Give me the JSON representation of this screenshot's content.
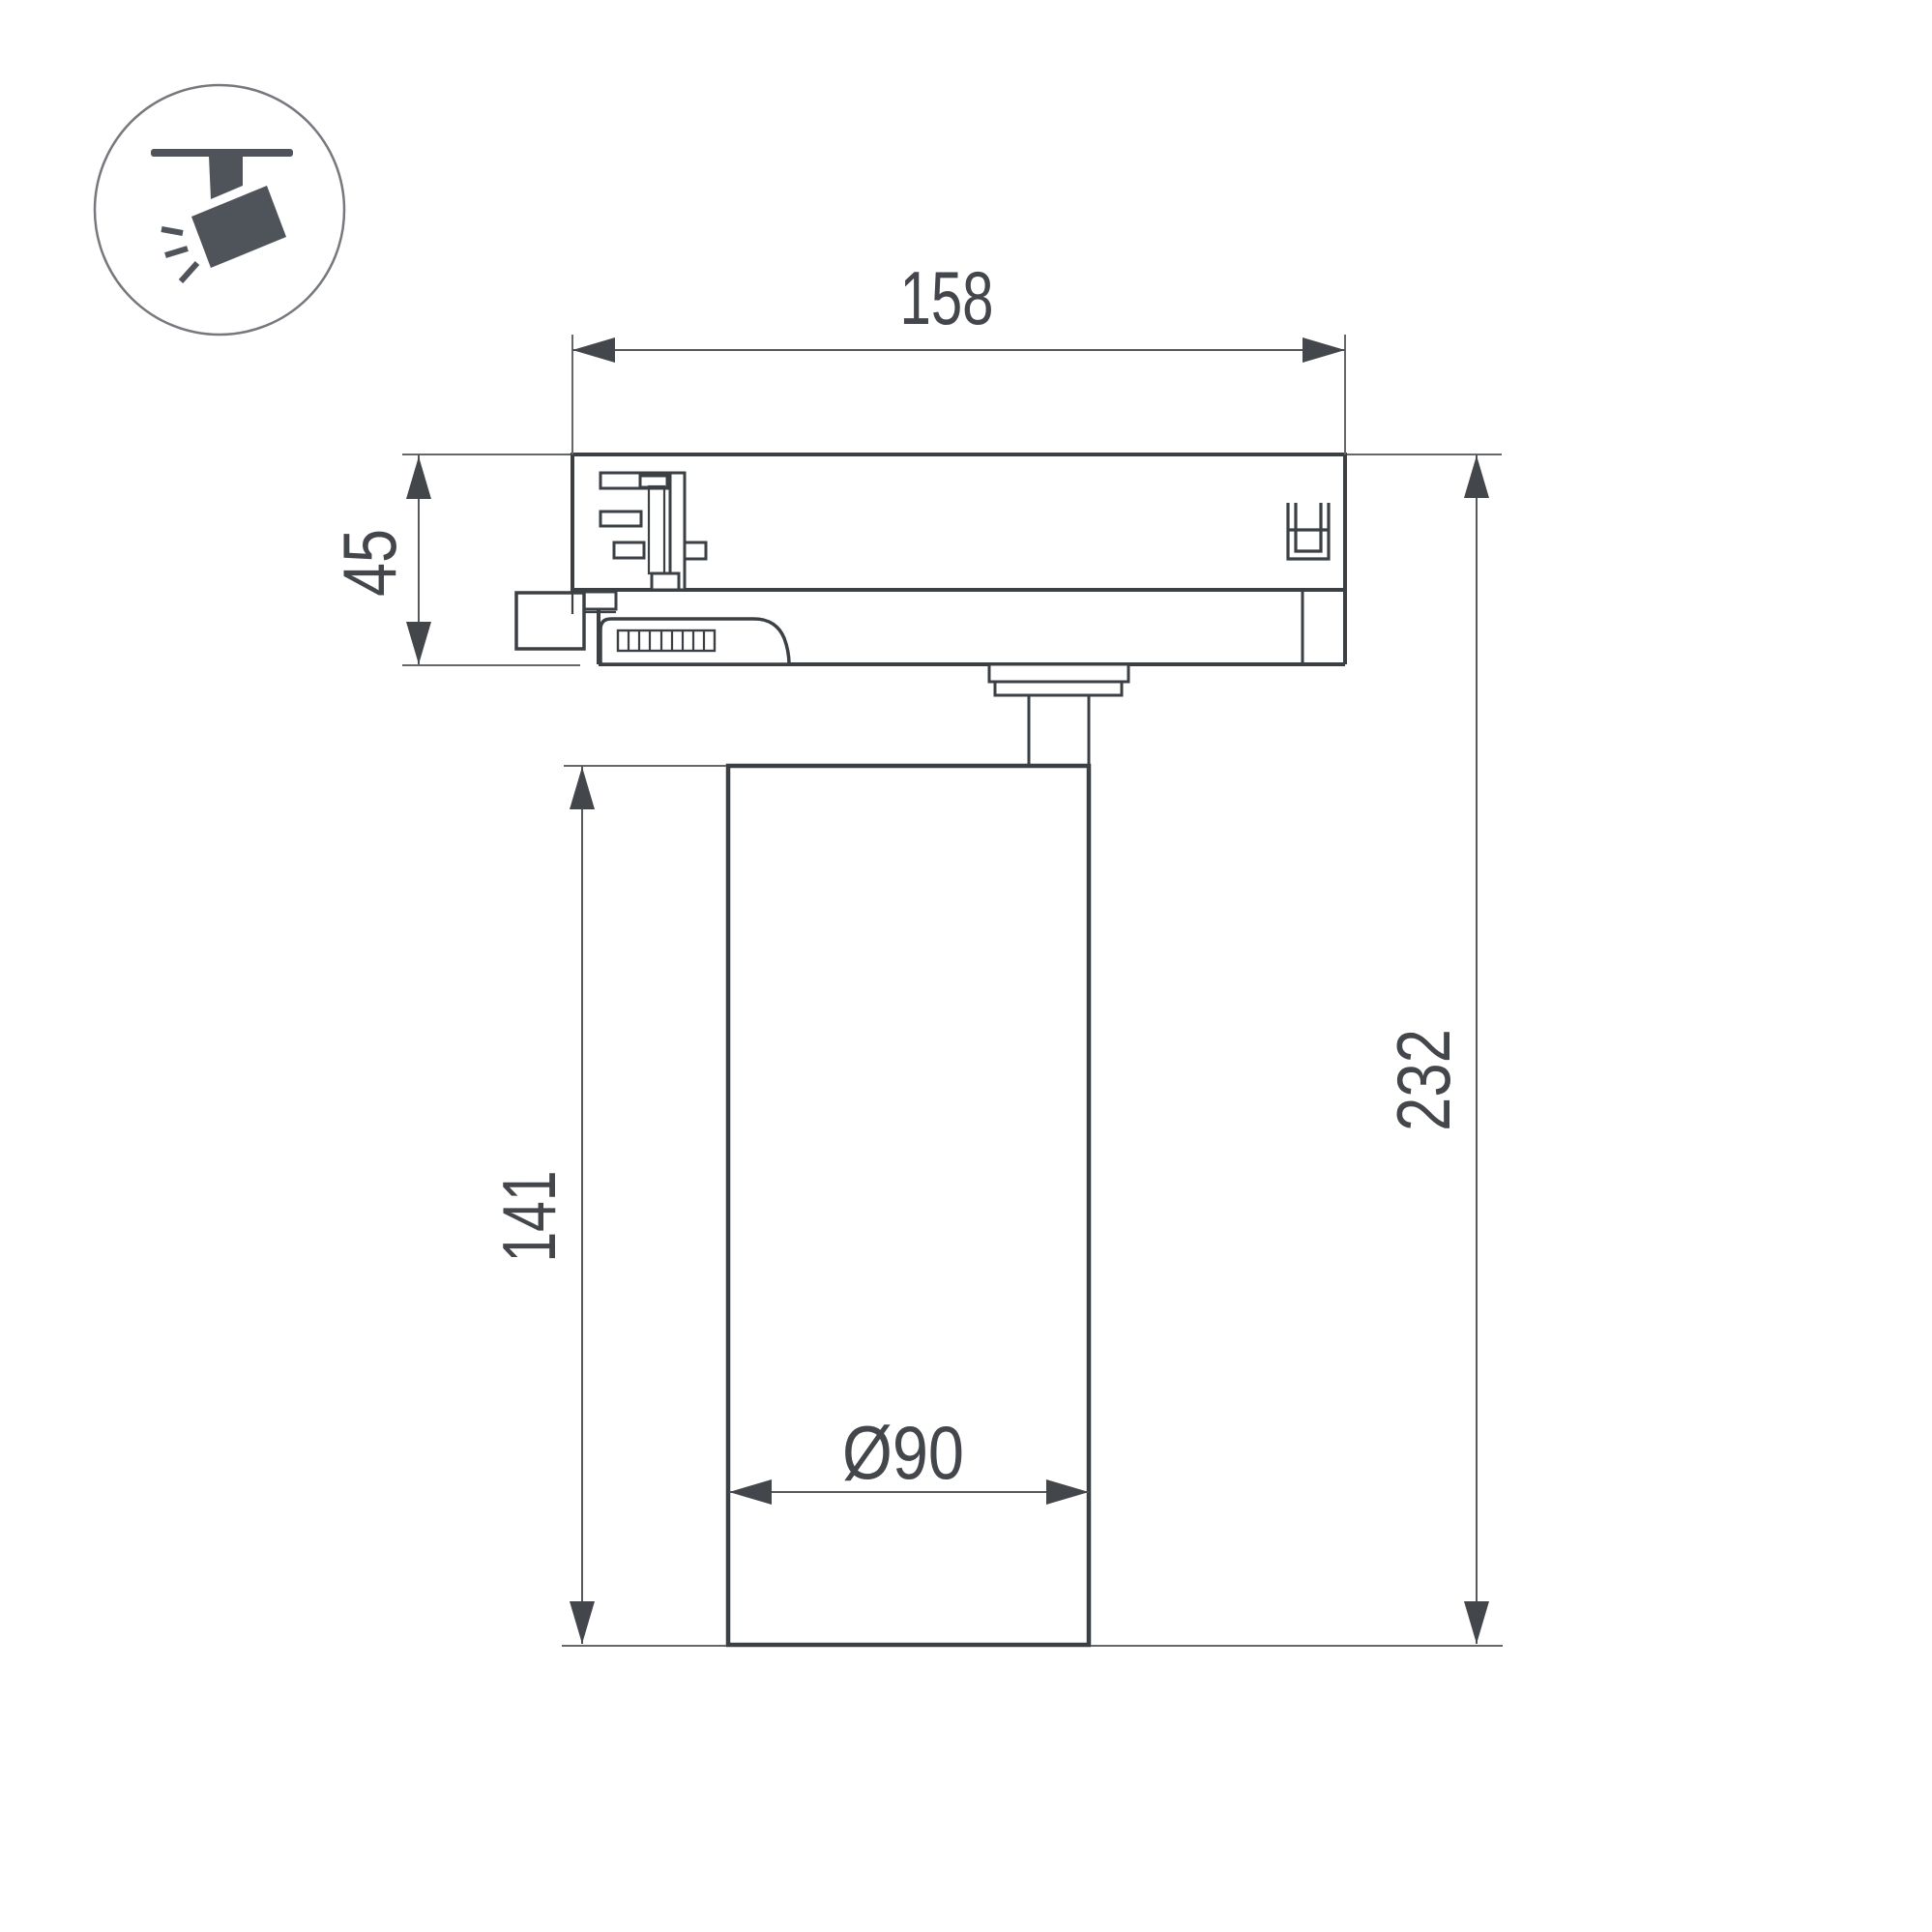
{
  "drawing": {
    "type": "track-spotlight dimensional drawing",
    "dimensions": {
      "adapter_width": "158",
      "adapter_height": "45",
      "body_height": "141",
      "overall_height": "232",
      "body_diameter": "Ø90"
    }
  },
  "icon": {
    "name": "track-spotlight-icon"
  },
  "colors": {
    "background": "#ffffff",
    "outline": "#3b4044",
    "dimension_lines": "#55595d",
    "dimension_text": "#43474b",
    "icon_glyph": "#4e545a",
    "icon_circle_stroke": "#75797d"
  }
}
